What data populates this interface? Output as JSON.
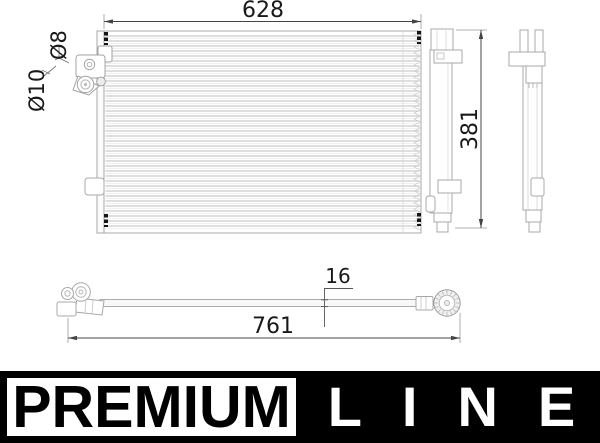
{
  "dimensions": {
    "core_width": "628",
    "core_height": "381",
    "port_small_diameter": "Ø8",
    "port_large_diameter": "Ø10",
    "pipe_diameter": "16",
    "pipe_length": "761"
  },
  "logo": {
    "premium": "PREMIUM",
    "line": "LINE"
  },
  "colors": {
    "outline": "#a8a8a8",
    "fin_line": "#c9c9c9",
    "dimension_line": "#444444",
    "dimension_text": "#191919",
    "mount_mark": "#151515",
    "logo_background": "#000000",
    "logo_text_light": "#ffffff"
  }
}
